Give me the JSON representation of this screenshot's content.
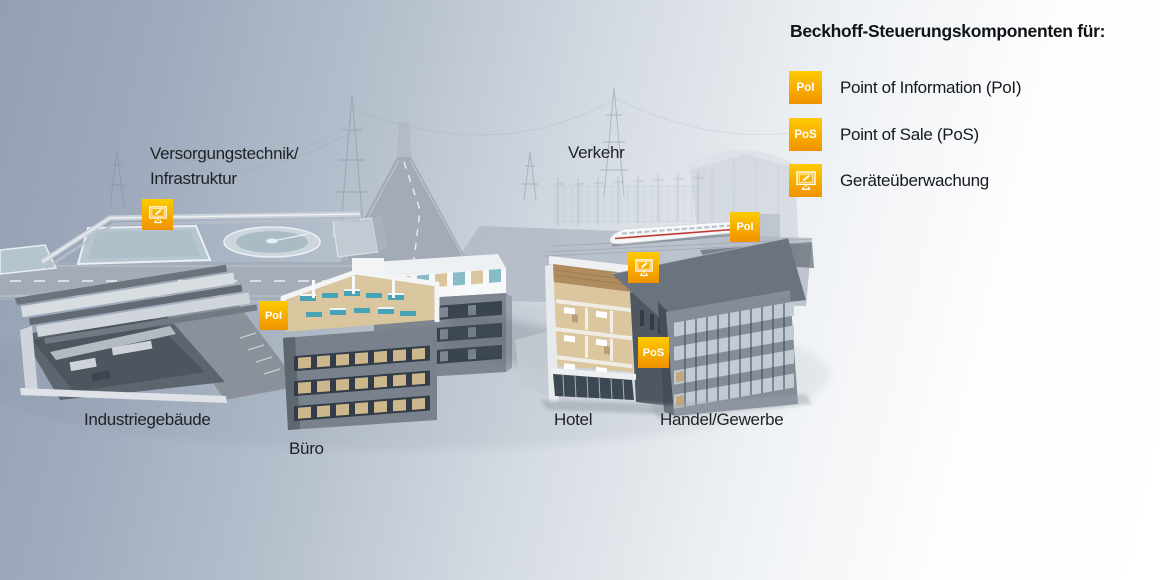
{
  "legend": {
    "title": "Beckhoff-Steuerungskomponenten für:",
    "items": [
      {
        "badge": "PoI",
        "label": "Point of Information (PoI)"
      },
      {
        "badge": "PoS",
        "label": "Point of Sale (PoS)"
      },
      {
        "badge": "",
        "icon": "monitor-icon",
        "label": "Geräteüberwachung"
      }
    ]
  },
  "scene": {
    "labels": {
      "infrastructure_line1": "Versorgungstechnik/",
      "infrastructure_line2": "Infrastruktur",
      "traffic": "Verkehr",
      "industrial": "Industriegebäude",
      "office": "Büro",
      "hotel": "Hotel",
      "commerce": "Handel/Gewerbe"
    },
    "markers": [
      {
        "id": "monitor-infrastructure",
        "type": "monitor",
        "label": ""
      },
      {
        "id": "poi-office",
        "type": "text",
        "label": "PoI"
      },
      {
        "id": "poi-traffic",
        "type": "text",
        "label": "PoI"
      },
      {
        "id": "monitor-hotel",
        "type": "monitor",
        "label": ""
      },
      {
        "id": "pos-commerce",
        "type": "text",
        "label": "PoS"
      }
    ]
  },
  "colors": {
    "badge_gradient_top": "#fdcb03",
    "badge_gradient_bottom": "#f09200",
    "label_text": "#1d2226",
    "background_left": "#93a0b2",
    "background_right": "#ffffff"
  }
}
